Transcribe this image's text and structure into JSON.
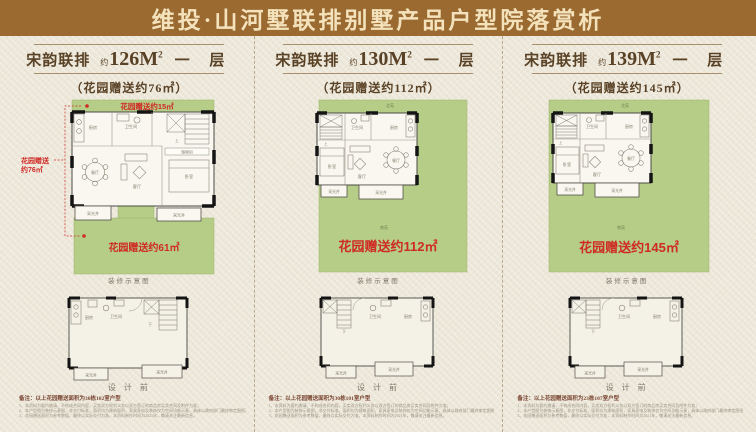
{
  "title": "维投·山河墅联排别墅产品户型院落赏析",
  "panels": [
    {
      "series": "宋韵联排",
      "approx": "约",
      "area": "126M",
      "area_sup": "2",
      "floor": "一 层",
      "subtitle": "（花园赠送约76㎡）",
      "plan": {
        "garden_top_label": "花园赠送约15㎡",
        "garden_main_label": "花园赠送约61㎡",
        "side_label_line1": "花园赠送",
        "side_label_line2": "约76㎡",
        "rooms": {
          "kitchen": "厨房",
          "bath": "卫生间",
          "stairs_up": "上",
          "storage": "储物间",
          "dining": "餐厅",
          "living": "客厅",
          "bedroom": "卧室",
          "well_left": "采光井",
          "well_right": "采光井"
        }
      },
      "caption_main": "装修示意图",
      "small_plan": {
        "rooms": {
          "kitchen": "厨房",
          "bath": "卫生间",
          "stairs_down": "下",
          "well_left": "采光井",
          "well_right": "采光井"
        }
      },
      "caption_small": "设 计 前",
      "note": "备注：以上花园赠送面积为30栋102室户型",
      "disclaimers": [
        "1、本资料为要约邀请，不构成合同内容，买卖双方权利义务以双方签订的商品房买卖合同及附件为准；",
        "2、本户型图为装修示意图，非交付标准，面积均为建筑面积，家具家电及装饰仅为空间功能示意，具体以政府部门最终审定图纸及商品房买卖合同约定为准；",
        "3、花园赠送面积为参考数值，最终以实际交付为准，本资料制作时间为2021年，敬请关注最新信息。"
      ]
    },
    {
      "series": "宋韵联排",
      "approx": "约",
      "area": "130M",
      "area_sup": "2",
      "floor": "一 层",
      "subtitle": "（花园赠送约112㎡）",
      "plan": {
        "north_label": "北苑",
        "south_label": "南苑",
        "garden_main_label": "花园赠送约112㎡",
        "rooms": {
          "kitchen": "厨房",
          "bath": "卫生间",
          "stairs_up": "上",
          "dining": "餐厅",
          "living": "客厅",
          "bedroom": "卧室",
          "well_left": "采光井",
          "well_right": "采光井"
        }
      },
      "caption_main": "装修示意图",
      "small_plan": {
        "rooms": {
          "kitchen": "厨房",
          "bath": "卫生间",
          "stairs_down": "下",
          "well_left": "采光井",
          "well_right": "采光井"
        }
      },
      "caption_small": "设 计 前",
      "note": "备注：以上花园赠送面积为30栋101室户型",
      "disclaimers": [
        "1、本资料为要约邀请，不构成合同内容，买卖双方权利义务以双方签订的商品房买卖合同及附件为准；",
        "2、本户型图为装修示意图，非交付标准，面积均为建筑面积，家具家电及装饰仅为空间功能示意，具体以政府部门最终审定图纸及商品房买卖合同约定为准；",
        "3、花园赠送面积为参考数值，最终以实际交付为准，本资料制作时间为2021年，敬请关注最新信息。"
      ]
    },
    {
      "series": "宋韵联排",
      "approx": "约",
      "area": "139M",
      "area_sup": "2",
      "floor": "一 层",
      "subtitle": "（花园赠送约145㎡）",
      "plan": {
        "north_label": "北苑",
        "south_label": "南苑",
        "garden_main_label": "花园赠送约145㎡",
        "rooms": {
          "kitchen": "厨房",
          "bath": "卫生间",
          "stairs_up": "上",
          "dining": "餐厅",
          "living": "客厅",
          "bedroom": "卧室",
          "well_left": "采光井",
          "well_right": "采光井"
        }
      },
      "caption_main": "装修示意图",
      "small_plan": {
        "rooms": {
          "kitchen": "厨房",
          "bath": "卫生间",
          "stairs_down": "下",
          "well_left": "采光井",
          "well_right": "采光井"
        }
      },
      "caption_small": "设 计 前",
      "note": "备注：以上花园赠送面积为23栋107室户型",
      "disclaimers": [
        "1、本资料为要约邀请，不构成合同内容，买卖双方权利义务以双方签订的商品房买卖合同及附件为准；",
        "2、本户型图为装修示意图，非交付标准，面积均为建筑面积，家具家电及装饰仅为空间功能示意，具体以政府部门最终审定图纸及商品房买卖合同约定为准；",
        "3、花园赠送面积为参考数值，最终以实际交付为准，本资料制作时间为2021年，敬请关注最新信息。"
      ]
    }
  ],
  "colors": {
    "band_brown": "#9a6a31",
    "title_cream": "#f3e2bb",
    "paper": "#ece7d9",
    "garden_green": "#b5cd87",
    "accent_red": "#cf2a24",
    "header_brown": "#5a4226"
  }
}
